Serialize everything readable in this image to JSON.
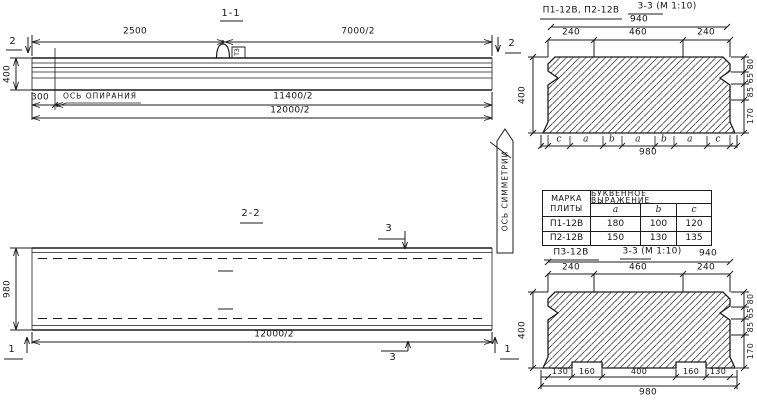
{
  "drawing": {
    "section_1_1": {
      "title": "1-1",
      "cut_mark_left": "2",
      "cut_mark_right": "2",
      "dim_top_left": "2500",
      "dim_top_right": "7000/2",
      "dim_height": "400",
      "dim_support_offset": "300",
      "support_axis_label": "ОСЬ ОПИРАНИЯ",
      "dim_half_span_support": "11400/2",
      "dim_half_span": "12000/2",
      "loop_mark": "ТЗ"
    },
    "section_2_2": {
      "title": "2-2",
      "cut_mark_top": "3",
      "cut_mark_bottom": "3",
      "cut_mark_left": "1",
      "cut_mark_right": "1",
      "dim_width": "980",
      "dim_half_span": "12000/2",
      "symmetry_axis_label": "ОСЬ СИММЕТРИИ"
    },
    "section_3_3_top": {
      "label": "П1-12В, П2-12В",
      "title": "3-3 (М 1:10)",
      "dim_top_overall": "940",
      "top_segments": [
        "240",
        "460",
        "240"
      ],
      "dim_height": "400",
      "right_segments": [
        "80",
        "65",
        "85",
        "170"
      ],
      "bottom_letters": [
        "с",
        "а",
        "b",
        "а",
        "b",
        "а",
        "с"
      ],
      "dim_bottom_overall": "980"
    },
    "plate_table": {
      "header_col1_line1": "МАРКА",
      "header_col1_line2": "ПЛИТЫ",
      "header_span": "БУКВЕННОЕ ВЫРАЖЕНИЕ",
      "letter_columns": [
        "a",
        "b",
        "c"
      ],
      "rows": [
        {
          "mark": "П1-12В",
          "a": "180",
          "b": "100",
          "c": "120"
        },
        {
          "mark": "П2-12В",
          "a": "150",
          "b": "130",
          "c": "135"
        }
      ]
    },
    "section_3_3_bottom": {
      "label": "П3-12В",
      "title": "3-3 (М 1:10)",
      "dim_top_overall": "940",
      "top_segments": [
        "240",
        "460",
        "240"
      ],
      "dim_height": "400",
      "right_segments": [
        "80",
        "65",
        "85",
        "170"
      ],
      "bottom_segments": [
        "130",
        "160",
        "400",
        "160",
        "130"
      ],
      "dim_bottom_overall": "980"
    }
  }
}
